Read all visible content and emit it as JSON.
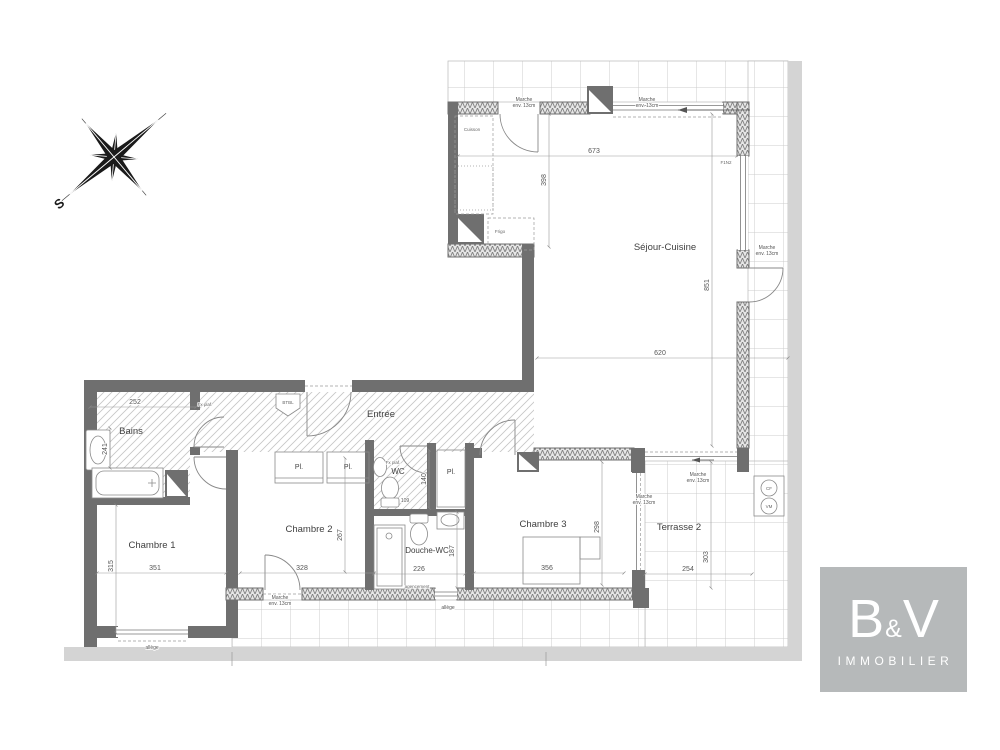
{
  "plan": {
    "rooms": [
      {
        "label": "Séjour-Cuisine"
      },
      {
        "label": "Entrée"
      },
      {
        "label": "Bains"
      },
      {
        "label": "WC"
      },
      {
        "label": "Chambre 1"
      },
      {
        "label": "Chambre 2"
      },
      {
        "label": "Douche-WC"
      },
      {
        "label": "Chambre 3"
      },
      {
        "label": "Terrasse 2"
      }
    ],
    "closets": {
      "label": "Pl."
    },
    "dimensions": {
      "sejour_top": "673",
      "kitchen_depth": "398",
      "sejour_width": "620",
      "sejour_height": "851",
      "bains_width": "252",
      "bains_height": "241",
      "ch1_w": "351",
      "ch1_h": "315",
      "ch2_w": "328",
      "ch2_h": "267",
      "wc_h": "140",
      "wc_w": "109",
      "douche_w": "226",
      "douche_h": "187",
      "ch3_w": "356",
      "ch3_h": "298",
      "terr2_w": "254",
      "terr2_h": "303"
    },
    "notes": {
      "marche": "Marche",
      "marche_sub": "env. 13cm",
      "allege": "allège",
      "fx_plaf": "Fx plaf.",
      "cuisson": "Cuisson",
      "frigo": "Frigo",
      "window_ref": "F1N2",
      "btbl": "BTBL",
      "agencement": "agencement",
      "cf": "CF",
      "vm": "VM"
    },
    "compass": {
      "south": "S"
    }
  },
  "logo": {
    "b": "B",
    "amp": "&",
    "v": "V",
    "sub": "IMMOBILIER"
  }
}
